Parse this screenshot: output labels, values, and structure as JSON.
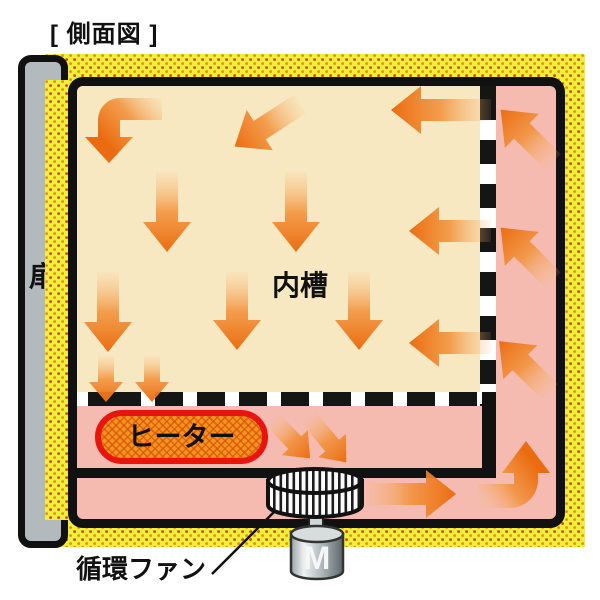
{
  "title": "[ 側面図 ]",
  "diagram": {
    "door_label": "扉",
    "chamber_label": "内槽",
    "heater_label": "ヒーター",
    "fan_label": "循環ファン",
    "motor_label": "M"
  },
  "colors": {
    "casing_yellow": "#edf138",
    "casing_dot_orange": "#e8881e",
    "casing_dot_red": "#df3a1a",
    "air_path_pink": "#f5bbb0",
    "chamber_cream": "#f8e8c2",
    "arrow_orange": "#eb6c10",
    "heater_fill": "#f2951d",
    "heater_border": "#e8150f",
    "door_gray": "#b3babd",
    "outline_black": "#111111"
  }
}
